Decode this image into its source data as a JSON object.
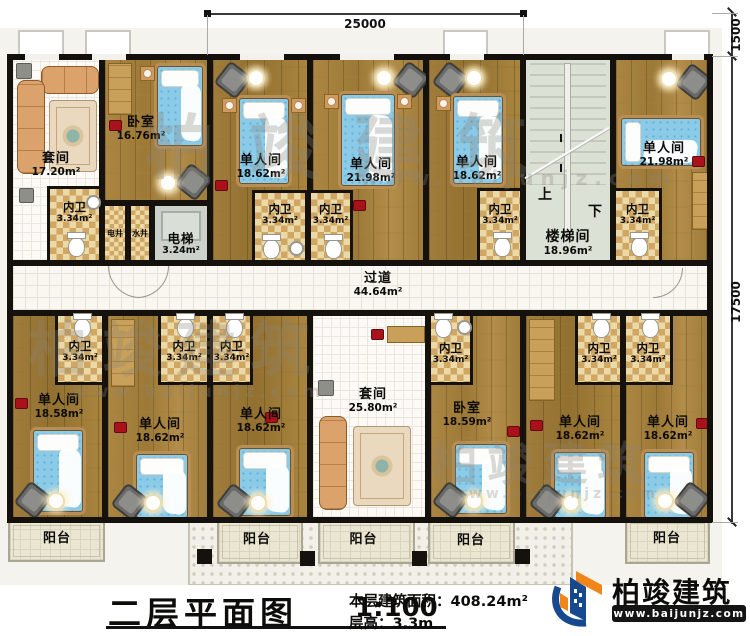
{
  "plan": {
    "dimensions": {
      "top": "25000",
      "right_upper": "1500",
      "right_lower": "17500"
    },
    "rooms": {
      "suite_top": {
        "label": "套间",
        "area": "17.20m²"
      },
      "bedroom_top": {
        "label": "卧室",
        "area": "16.76m²"
      },
      "single_t1": {
        "label": "单人间",
        "area": "18.62m²"
      },
      "single_t2": {
        "label": "单人间",
        "area": "21.98m²"
      },
      "single_t3": {
        "label": "单人间",
        "area": "18.62m²"
      },
      "stairwell": {
        "label": "楼梯间",
        "area": "18.96m²",
        "up": "上",
        "down": "下"
      },
      "single_t4": {
        "label": "单人间",
        "area": "21.98m²"
      },
      "corridor": {
        "label": "过道",
        "area": "44.64m²"
      },
      "elevator": {
        "label": "电梯",
        "area": "3.24m²"
      },
      "elec_shaft": {
        "label": "电井"
      },
      "water_shaft": {
        "label": "水井"
      },
      "bath": {
        "label": "内卫",
        "area": "3.34m²"
      },
      "single_b1": {
        "label": "单人间",
        "area": "18.58m²"
      },
      "single_b2": {
        "label": "单人间",
        "area": "18.62m²"
      },
      "single_b3": {
        "label": "单人间",
        "area": "18.62m²"
      },
      "suite_bottom": {
        "label": "套间",
        "area": "25.80m²"
      },
      "bedroom_bottom": {
        "label": "卧室",
        "area": "18.59m²"
      },
      "single_b4": {
        "label": "单人间",
        "area": "18.62m²"
      },
      "single_b5": {
        "label": "单人间",
        "area": "18.62m²"
      },
      "balcony": {
        "label": "阳台"
      }
    }
  },
  "title_block": {
    "title": "二层平面图",
    "scale": "1:100",
    "area_label": "本层建筑面积：",
    "area_value": "408.24m²",
    "height_label": "层高：",
    "height_value": "3.3m"
  },
  "brand": {
    "name": "柏竣建筑",
    "website": "www.baijunjz.com"
  },
  "watermark": {
    "text": "柏竣建筑",
    "website": "www.baijunjz.com"
  }
}
